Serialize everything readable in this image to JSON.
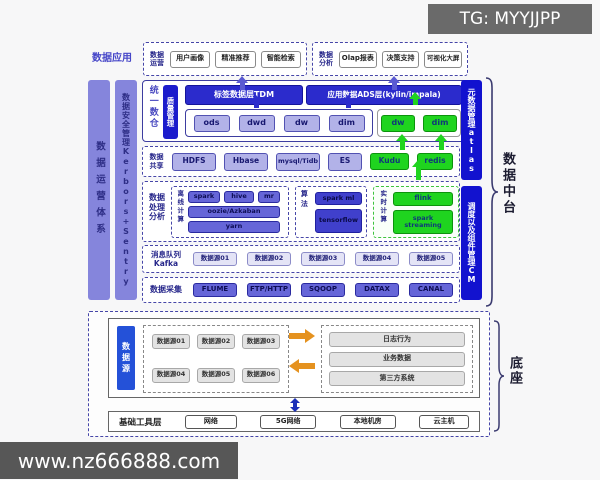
{
  "header": {
    "tg_badge": "TG: MYYJJPP"
  },
  "footer": {
    "watermark": "www.nz666888.com"
  },
  "app": {
    "section_label": "数据应用",
    "groups": [
      {
        "label": "数据运营",
        "items": [
          "用户画像",
          "精准推荐",
          "智能检索"
        ]
      },
      {
        "label": "数据分析",
        "items": [
          "Olap报表",
          "决策支持",
          "可视化大屏"
        ]
      }
    ]
  },
  "left_bars": {
    "ops": "数据运营体系",
    "security": "数据安全管理Kerbors+Sentry"
  },
  "warehouse": {
    "section_label": "统一数仓",
    "quality_bar": "质量管理",
    "tdm_header": "标签数据层TDM",
    "ads_header": "应用数据ADS层(kylin/impala)",
    "layers": [
      "ods",
      "dwd",
      "dw",
      "dim"
    ],
    "green_layers": [
      "dw",
      "dim"
    ]
  },
  "share": {
    "label": "数据共享",
    "items": [
      "HDFS",
      "Hbase",
      "mysql/Tidb",
      "ES"
    ],
    "green_items": [
      "Kudu",
      "redis"
    ]
  },
  "process": {
    "label": "数据处理分析",
    "offline": {
      "label": "离线计算",
      "engines": [
        "spark",
        "hive",
        "mr"
      ],
      "scheduler": "oozie/Azkaban",
      "resource": "yarn"
    },
    "algo": {
      "label": "算法",
      "items": [
        "spark ml",
        "tensorflow"
      ]
    },
    "realtime": {
      "label": "实时计算",
      "items": [
        "flink",
        "spark streaming"
      ]
    }
  },
  "kafka": {
    "label": "消息队列Kafka",
    "items": [
      "数据源01",
      "数据源02",
      "数据源03",
      "数据源04",
      "数据源05"
    ]
  },
  "collect": {
    "label": "数据采集",
    "items": [
      "FLUME",
      "FTP/HTTP",
      "SQOOP",
      "DATAX",
      "CANAL"
    ]
  },
  "right_bars": {
    "metadata": "元数据管理atlas",
    "scheduling": "调度以及组件管理CM"
  },
  "middle_brace_label": "数据中台",
  "base": {
    "source_bar": "数据源",
    "sources": [
      "数据源01",
      "数据源02",
      "数据源03",
      "数据源04",
      "数据源05",
      "数据源06"
    ],
    "targets": [
      "日志行为",
      "业务数据",
      "第三方系统"
    ],
    "tools": {
      "label": "基础工具层",
      "items": [
        "网络",
        "5G网络",
        "本地机房",
        "云主机"
      ]
    },
    "brace_label": "底座"
  },
  "colors": {
    "deep_blue": "#2b2bcc",
    "bright_green": "#1fd41f",
    "purple_bar": "#8585dc",
    "orange": "#e5921f",
    "right_bar_blue": "#1212cf",
    "source_blue": "#2451d8"
  }
}
